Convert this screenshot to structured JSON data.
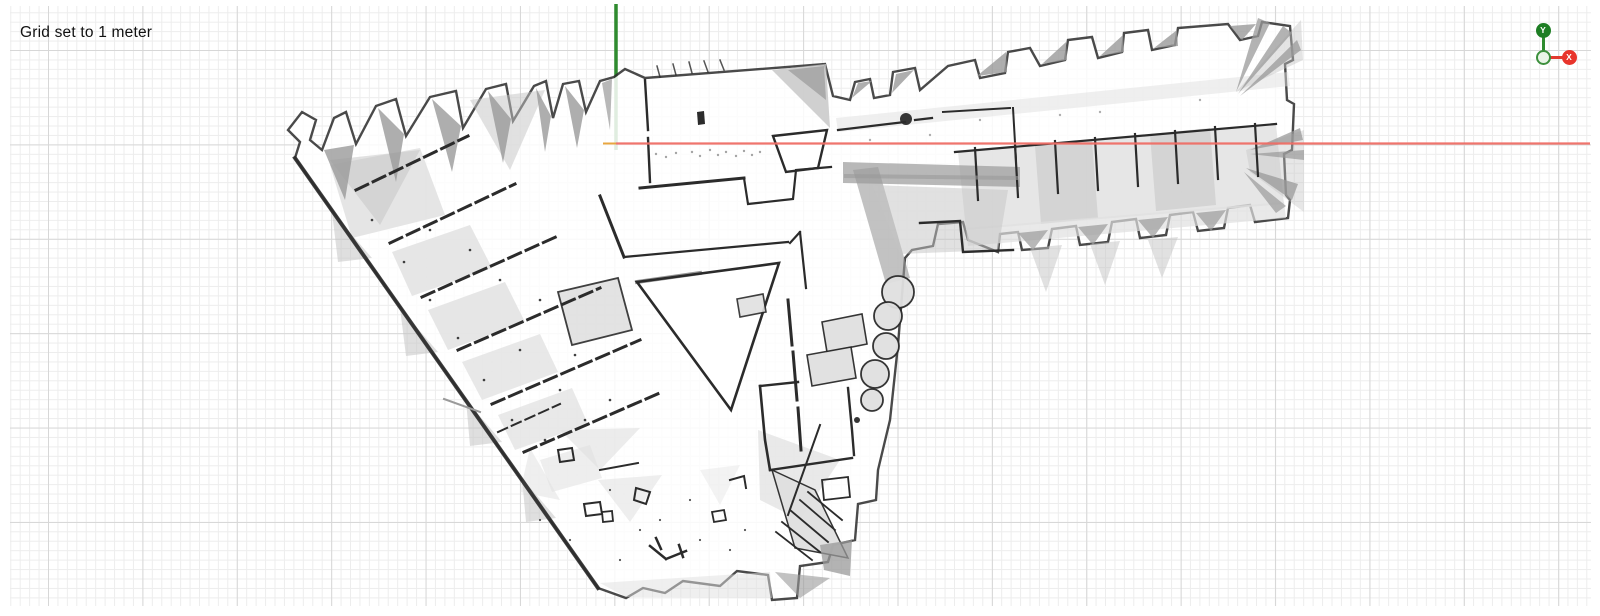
{
  "viewer": {
    "status_text": "Grid set to 1 meter",
    "grid": {
      "unit_label": "1 meter",
      "minor_px": 9.44,
      "major_px": 94.4,
      "offset_x": 38,
      "offset_y": 44,
      "minor_color": "#ededed",
      "major_color": "#d7d7d7",
      "background": "#ffffff"
    },
    "axes": {
      "origin": {
        "x": 616,
        "y": 143.5
      },
      "y_axis": {
        "color": "#2f8b2f",
        "from_y": 4,
        "to_y": 150,
        "width": 3.5
      },
      "x_axis": {
        "color": "#ef6e66",
        "to_x": 1590,
        "width": 2.2
      },
      "neg_x_tick": {
        "color": "#e8a640",
        "from_x": 603,
        "width": 2
      }
    },
    "gizmo": {
      "y_label": "Y",
      "x_label": "X",
      "y_color": "#1e7e24",
      "x_color": "#e8342b",
      "y_line_color": "#2f8b2f",
      "x_line_color": "#e23a2e",
      "origin_fill": "#e9f4e7",
      "origin_stroke": "#3c8f3c"
    }
  },
  "map": {
    "palette": {
      "k": "#2b2b2b",
      "m": "#9a9a9a",
      "g": "#c4c4c4",
      "l": "#e0e0e0",
      "w": "#ffffff"
    },
    "shapes": [
      {
        "d": "M598,588 L295,158 L300,142 L288,130 L302,112 L316,120 L310,140 L322,150 L334,118 L346,112 L356,144 L376,106 L396,99 L406,136 L430,97 L456,91 L463,128 L486,89 L506,84 L513,121 L534,86 L546,81 L553,118 L563,84 L579,81 L586,112 L600,81 L614,77 L625,69 L645,78 L825,64 L833,96 L850,100 L855,82 L870,79 L874,98 L890,95 L893,72 L915,68 L920,90 L948,66 L975,60 L980,78 L1005,73 L1008,52 L1030,48 L1040,66 L1065,60 L1068,40 L1092,37 L1098,58 L1122,52 L1124,33 L1148,30 L1152,50 L1175,45 L1178,28 L1228,24 L1240,40 L1258,36 L1262,22 L1290,26 L1293,60 L1285,64 L1287,100 L1294,104 L1292,150 L1284,154 L1286,195 L1290,200 L1288,218 L1255,222 L1250,205 L1228,208 L1224,228 L1198,231 L1193,212 L1170,215 L1166,235 L1140,238 L1136,219 L1112,222 L1108,242 L1080,245 L1076,226 L1052,229 L1048,248 L1022,250 L1018,232 L1000,234 L998,252 L968,240 L963,222 L938,224 L933,246 L912,250 L905,258 L898,345 L890,420 L878,470 L876,500 L858,504 L855,540 L833,545 L828,562 L800,566 L797,598 L772,600 L768,575 L737,571 L720,586 L683,581 L665,593 L643,588 L626,598 Z",
        "f": "w",
        "o": 0.85,
        "s": "k",
        "w": 2.4
      },
      {
        "d": "M330,165 L420,148 L445,215 L352,238 Z",
        "f": "l",
        "o": 0.85
      },
      {
        "d": "M392,252 L470,225 L492,268 L412,296 Z",
        "f": "l",
        "o": 0.8
      },
      {
        "d": "M428,310 L505,282 L525,322 L448,350 Z",
        "f": "l",
        "o": 0.8
      },
      {
        "d": "M462,362 L540,334 L558,372 L482,400 Z",
        "f": "l",
        "o": 0.75
      },
      {
        "d": "M498,415 L572,388 L588,424 L515,450 Z",
        "f": "l",
        "o": 0.7
      },
      {
        "d": "M558,292 L618,278 L632,330 L572,345 Z",
        "f": "l",
        "s": "k",
        "w": 1.8,
        "o": 0.9
      },
      {
        "d": "M540,460 L590,445 L602,478 L552,492 Z",
        "f": "l",
        "o": 0.55
      },
      {
        "d": "M330,160 L420,150 L380,225 Z",
        "f": "g",
        "o": 0.5
      },
      {
        "d": "M470,100 L545,90 L510,170 Z",
        "f": "g",
        "o": 0.5
      },
      {
        "d": "M324,150 L354,145 L345,200 Z",
        "f": "m",
        "o": 0.8
      },
      {
        "d": "M378,108 L404,134 L396,182 Z",
        "f": "m",
        "o": 0.8
      },
      {
        "d": "M432,99 L461,126 L452,172 Z",
        "f": "m",
        "o": 0.8
      },
      {
        "d": "M488,91 L511,119 L503,163 Z",
        "f": "m",
        "o": 0.8
      },
      {
        "d": "M536,88 L551,116 L545,152 Z",
        "f": "m",
        "o": 0.8
      },
      {
        "d": "M565,86 L584,110 L577,148 Z",
        "f": "m",
        "o": 0.8
      },
      {
        "d": "M602,83 L612,79 L610,130 Z",
        "f": "m",
        "o": 0.7
      },
      {
        "d": "M772,70 L826,64 L830,128 L798,96 Z",
        "f": "g",
        "o": 0.8
      },
      {
        "d": "M788,70 L824,66 L826,100 Z",
        "f": "m",
        "o": 0.7
      },
      {
        "d": "M958,152 L1276,124 L1284,204 L966,230 Z",
        "f": "l",
        "o": 0.8
      },
      {
        "d": "M1035,146 L1092,141 L1098,218 L1041,224 Z",
        "f": "g",
        "o": 0.55
      },
      {
        "d": "M1150,134 L1210,128 L1216,205 L1156,211 Z",
        "f": "g",
        "o": 0.55
      },
      {
        "d": "M836,118 L1288,72 L1290,86 L838,132 Z",
        "f": "l",
        "o": 0.5
      },
      {
        "d": "M966,228 L1284,202 L1286,218 L968,246 Z",
        "f": "l",
        "o": 0.7
      },
      {
        "d": "M852,98 L858,83 L872,81 Z",
        "f": "m",
        "o": 0.8
      },
      {
        "d": "M892,93 L896,74 L914,70 Z",
        "f": "m",
        "o": 0.8
      },
      {
        "d": "M977,76 L1006,52 L1007,72 Z",
        "f": "m",
        "o": 0.8
      },
      {
        "d": "M1042,64 L1066,42 L1067,60 Z",
        "f": "m",
        "o": 0.8
      },
      {
        "d": "M1100,56 L1123,35 L1124,52 Z",
        "f": "m",
        "o": 0.8
      },
      {
        "d": "M1154,48 L1177,30 L1178,46 Z",
        "f": "m",
        "o": 0.8
      },
      {
        "d": "M1230,26 L1256,24 L1242,40 Z",
        "f": "m",
        "o": 0.8
      },
      {
        "d": "M1018,233 L1048,230 L1033,250 Z",
        "f": "m",
        "o": 0.7
      },
      {
        "d": "M1078,227 L1108,224 L1093,245 Z",
        "f": "m",
        "o": 0.7
      },
      {
        "d": "M1138,220 L1168,217 L1153,238 Z",
        "f": "m",
        "o": 0.7
      },
      {
        "d": "M1196,213 L1226,210 L1211,231 Z",
        "f": "m",
        "o": 0.7
      },
      {
        "d": "M843,162 L1020,167 L1020,187 L843,183 Z",
        "f": "m",
        "o": 0.7
      },
      {
        "d": "M853,170 L878,167 L910,278 L886,284 Z",
        "f": "m",
        "o": 0.6
      },
      {
        "d": "M872,185 L1008,190 L998,250 L900,254 Z",
        "f": "g",
        "o": 0.5
      },
      {
        "d": "M1236,92 L1301,20 L1303,60 Z",
        "f": "g",
        "o": 0.45
      },
      {
        "d": "M1246,150 L1304,130 L1304,212 L1250,172 Z",
        "f": "g",
        "o": 0.4
      },
      {
        "d": "M1236,92 L1258,18 L1270,23 Z",
        "f": "m",
        "o": 0.75
      },
      {
        "d": "M1238,94 L1283,26 L1292,33 Z",
        "f": "m",
        "o": 0.75
      },
      {
        "d": "M1240,96 L1297,40 L1301,50 Z",
        "f": "m",
        "o": 0.75
      },
      {
        "d": "M1250,150 L1300,128 L1303,140 Z",
        "f": "m",
        "o": 0.75
      },
      {
        "d": "M1250,154 L1304,150 L1304,160 Z",
        "f": "m",
        "o": 0.7
      },
      {
        "d": "M1246,168 L1298,184 L1292,200 Z",
        "f": "m",
        "o": 0.75
      },
      {
        "d": "M1244,172 L1286,206 L1276,213 Z",
        "f": "m",
        "o": 0.7
      },
      {
        "d": "M1030,248 L1062,245 L1046,292 Z",
        "f": "g",
        "o": 0.5
      },
      {
        "d": "M1090,244 L1120,241 L1105,285 Z",
        "f": "g",
        "o": 0.5
      },
      {
        "d": "M1148,240 L1178,237 L1162,278 Z",
        "f": "g",
        "o": 0.5
      },
      {
        "d": "M332,212 L372,258 L338,262 Z",
        "f": "g",
        "o": 0.55
      },
      {
        "d": "M400,308 L438,352 L406,356 Z",
        "f": "g",
        "o": 0.55
      },
      {
        "d": "M466,400 L502,442 L470,446 Z",
        "f": "g",
        "o": 0.55
      },
      {
        "d": "M522,478 L556,518 L526,522 Z",
        "f": "g",
        "o": 0.55
      },
      {
        "d": "M560,430 L640,428 L600,470 Z",
        "f": "l",
        "o": 0.6
      },
      {
        "d": "M598,480 L662,475 L630,522 Z",
        "f": "l",
        "o": 0.55
      },
      {
        "d": "M530,448 L560,500 L520,492 Z",
        "f": "l",
        "o": 0.5
      },
      {
        "d": "M700,470 L740,465 L720,505 Z",
        "f": "l",
        "o": 0.4
      },
      {
        "d": "M600,583 L770,572 L772,598 L626,597 Z",
        "f": "l",
        "o": 0.5
      },
      {
        "d": "M758,430 L840,460 L800,520 L760,500 Z",
        "f": "l",
        "o": 0.7
      },
      {
        "d": "M772,470 L815,490 L848,558 L795,548 Z",
        "f": "l",
        "s": "k",
        "w": 1.5,
        "o": 0.95
      },
      {
        "d": "M808,492 L842,520 M800,500 L835,530 M790,510 L828,542 M782,522 L820,552 M776,532 L812,560",
        "s": "k",
        "w": 1.8
      },
      {
        "d": "M820,545 L852,540 L850,576 L824,570 Z",
        "f": "m",
        "o": 0.75
      },
      {
        "d": "M775,572 L830,578 L800,598 Z",
        "f": "m",
        "o": 0.6
      },
      {
        "d": "M637,282 L779,263 L731,410 Z",
        "f": "w",
        "o": 1,
        "s": "k",
        "w": 2.6
      },
      {
        "d": "M637,282 L700,273",
        "s": "k",
        "w": 4,
        "o": 0.5
      },
      {
        "d": "M773,136 L827,130 L818,168 L786,172 Z",
        "f": "w",
        "o": 1,
        "s": "k",
        "w": 2.4
      },
      {
        "d": "M295,158 L598,588",
        "s": "k",
        "w": 4,
        "o": 0.9
      },
      {
        "d": "M356,190 L468,136",
        "s": "k",
        "w": 3,
        "da": "13 6"
      },
      {
        "d": "M390,243 L515,184",
        "s": "k",
        "w": 3,
        "da": "13 6"
      },
      {
        "d": "M422,297 L558,236",
        "s": "k",
        "w": 3,
        "da": "13 6"
      },
      {
        "d": "M458,350 L600,288",
        "s": "k",
        "w": 3,
        "da": "13 6"
      },
      {
        "d": "M492,404 L640,340",
        "s": "k",
        "w": 3,
        "da": "13 6"
      },
      {
        "d": "M524,452 L662,392",
        "s": "k",
        "w": 3,
        "da": "13 6"
      },
      {
        "d": "M498,432 L560,404",
        "s": "k",
        "w": 2,
        "da": "10 5"
      },
      {
        "d": "M600,196 L624,257",
        "s": "k",
        "w": 3
      },
      {
        "d": "M624,257 L788,242",
        "s": "k",
        "w": 2.2
      },
      {
        "d": "M640,188 L744,178",
        "s": "k",
        "w": 3
      },
      {
        "d": "M744,178 L748,204 L793,199 L796,170 L831,167",
        "s": "k",
        "w": 2.2
      },
      {
        "d": "M660,77 L657,66 M676,75 L673,64 M692,73 L689,62 M708,72 L704,61 M724,70 L720,60",
        "s": "k",
        "w": 1.5,
        "o": 0.8
      },
      {
        "d": "M697,112 L704,111 L705,124 L698,125 Z",
        "f": "k"
      },
      {
        "d": "M645,80 L648,130 M648,138 L650,182",
        "s": "k",
        "w": 2.4
      },
      {
        "d": "M955,152 L1276,124",
        "s": "k",
        "w": 2.2
      },
      {
        "d": "M975,148 L978,200 M1015,145 L1018,197 M1055,141 L1058,193 M1095,138 L1098,190 M1135,134 L1138,186 M1175,131 L1178,183 M1215,127 L1218,179 M1255,124 L1258,176",
        "s": "k",
        "w": 2.2
      },
      {
        "d": "M846,176 L1016,178",
        "s": "m",
        "w": 4,
        "o": 0.6
      },
      {
        "d": "M838,130 L905,122 M915,120 L932,118",
        "s": "k",
        "w": 2.2
      },
      {
        "d": "M920,223 L960,221 L963,252 L1013,250",
        "s": "k",
        "w": 2.4
      },
      {
        "d": "M943,112 L1010,108 M1013,108 L1016,160",
        "s": "k",
        "w": 2
      },
      {
        "d": "M788,300 L792,345 M793,352 L797,400 M798,408 L801,450",
        "s": "k",
        "w": 3
      },
      {
        "d": "M790,243 L800,232 M800,232 L806,288",
        "s": "k",
        "w": 2.2
      },
      {
        "d": "M760,386 L765,440 L770,470",
        "s": "k",
        "w": 2.6
      },
      {
        "d": "M770,470 L852,458",
        "s": "k",
        "w": 2.4
      },
      {
        "d": "M848,388 L852,430 L854,455",
        "s": "k",
        "w": 2.4
      },
      {
        "d": "M760,386 L798,382",
        "s": "k",
        "w": 2.4
      },
      {
        "d": "M820,425 L788,515",
        "s": "k",
        "w": 2
      },
      {
        "d": "M822,480 L848,477 L850,497 L824,500 Z",
        "s": "k",
        "w": 1.8
      },
      {
        "d": "M558,450 L572,448 L574,460 L560,462 Z",
        "s": "k",
        "w": 2
      },
      {
        "d": "M584,504 L600,502 L602,514 L586,516 Z",
        "s": "k",
        "w": 2
      },
      {
        "d": "M602,512 L612,511 L613,521 L603,522 Z",
        "s": "k",
        "w": 1.8
      },
      {
        "d": "M600,470 L638,463",
        "s": "k",
        "w": 2
      },
      {
        "d": "M636,488 L650,492 L646,504 L634,500 Z",
        "s": "k",
        "w": 2
      },
      {
        "d": "M650,546 L666,559 M666,559 L686,551 M656,538 L661,549 M679,545 L683,557",
        "s": "k",
        "w": 2.5
      },
      {
        "d": "M712,512 L724,510 L726,520 L714,522 Z",
        "s": "k",
        "w": 1.8
      },
      {
        "d": "M730,480 L744,476 L746,488",
        "s": "k",
        "w": 2
      },
      {
        "d": "M444,399 L480,412",
        "s": "m",
        "w": 2
      },
      {
        "d": "M822,322 L862,314 L867,344 L827,352 Z",
        "f": "l",
        "s": "k",
        "w": 1.6,
        "o": 0.95
      },
      {
        "d": "M807,355 L851,347 L856,378 L812,386 Z",
        "f": "l",
        "s": "k",
        "w": 1.6,
        "o": 0.95
      },
      {
        "d": "M737,299 L763,294 L766,312 L740,317 Z",
        "f": "l",
        "s": "k",
        "w": 1.6,
        "o": 0.9
      }
    ],
    "circles": [
      [
        898,
        292,
        16,
        "l",
        "k",
        1.8
      ],
      [
        888,
        316,
        14,
        "l",
        "k",
        1.8
      ],
      [
        886,
        346,
        13,
        "l",
        "k",
        1.8
      ],
      [
        875,
        374,
        14,
        "l",
        "k",
        1.8
      ],
      [
        872,
        400,
        11,
        "l",
        "k",
        1.8
      ],
      [
        906,
        119,
        6,
        "k",
        null,
        0
      ],
      [
        857,
        420,
        3,
        "k",
        null,
        0
      ]
    ],
    "dot_groups": [
      {
        "f": "k",
        "r": 1.3,
        "o": 0.9,
        "pts": [
          [
            372,
            220
          ],
          [
            404,
            262
          ],
          [
            430,
            300
          ],
          [
            458,
            338
          ],
          [
            484,
            380
          ],
          [
            512,
            420
          ],
          [
            540,
            300
          ],
          [
            470,
            250
          ],
          [
            520,
            350
          ],
          [
            560,
            390
          ],
          [
            430,
            230
          ],
          [
            500,
            280
          ],
          [
            585,
            420
          ],
          [
            610,
            400
          ],
          [
            545,
            440
          ],
          [
            575,
            355
          ]
        ]
      },
      {
        "f": "m",
        "r": 1.2,
        "o": 0.9,
        "pts": [
          [
            692,
            152
          ],
          [
            700,
            156
          ],
          [
            710,
            150
          ],
          [
            718,
            155
          ],
          [
            726,
            152
          ],
          [
            736,
            156
          ],
          [
            744,
            151
          ],
          [
            752,
            155
          ],
          [
            760,
            152
          ],
          [
            656,
            154
          ],
          [
            666,
            157
          ],
          [
            676,
            153
          ]
        ]
      },
      {
        "f": "k",
        "r": 1.1,
        "o": 0.8,
        "pts": [
          [
            540,
            520
          ],
          [
            570,
            540
          ],
          [
            620,
            560
          ],
          [
            660,
            520
          ],
          [
            700,
            540
          ],
          [
            730,
            550
          ],
          [
            640,
            530
          ],
          [
            610,
            490
          ],
          [
            690,
            500
          ],
          [
            745,
            530
          ]
        ]
      },
      {
        "f": "m",
        "r": 1.2,
        "o": 0.8,
        "pts": [
          [
            1060,
            115
          ],
          [
            1100,
            112
          ],
          [
            980,
            120
          ],
          [
            1200,
            100
          ],
          [
            870,
            140
          ],
          [
            930,
            135
          ]
        ]
      }
    ]
  }
}
